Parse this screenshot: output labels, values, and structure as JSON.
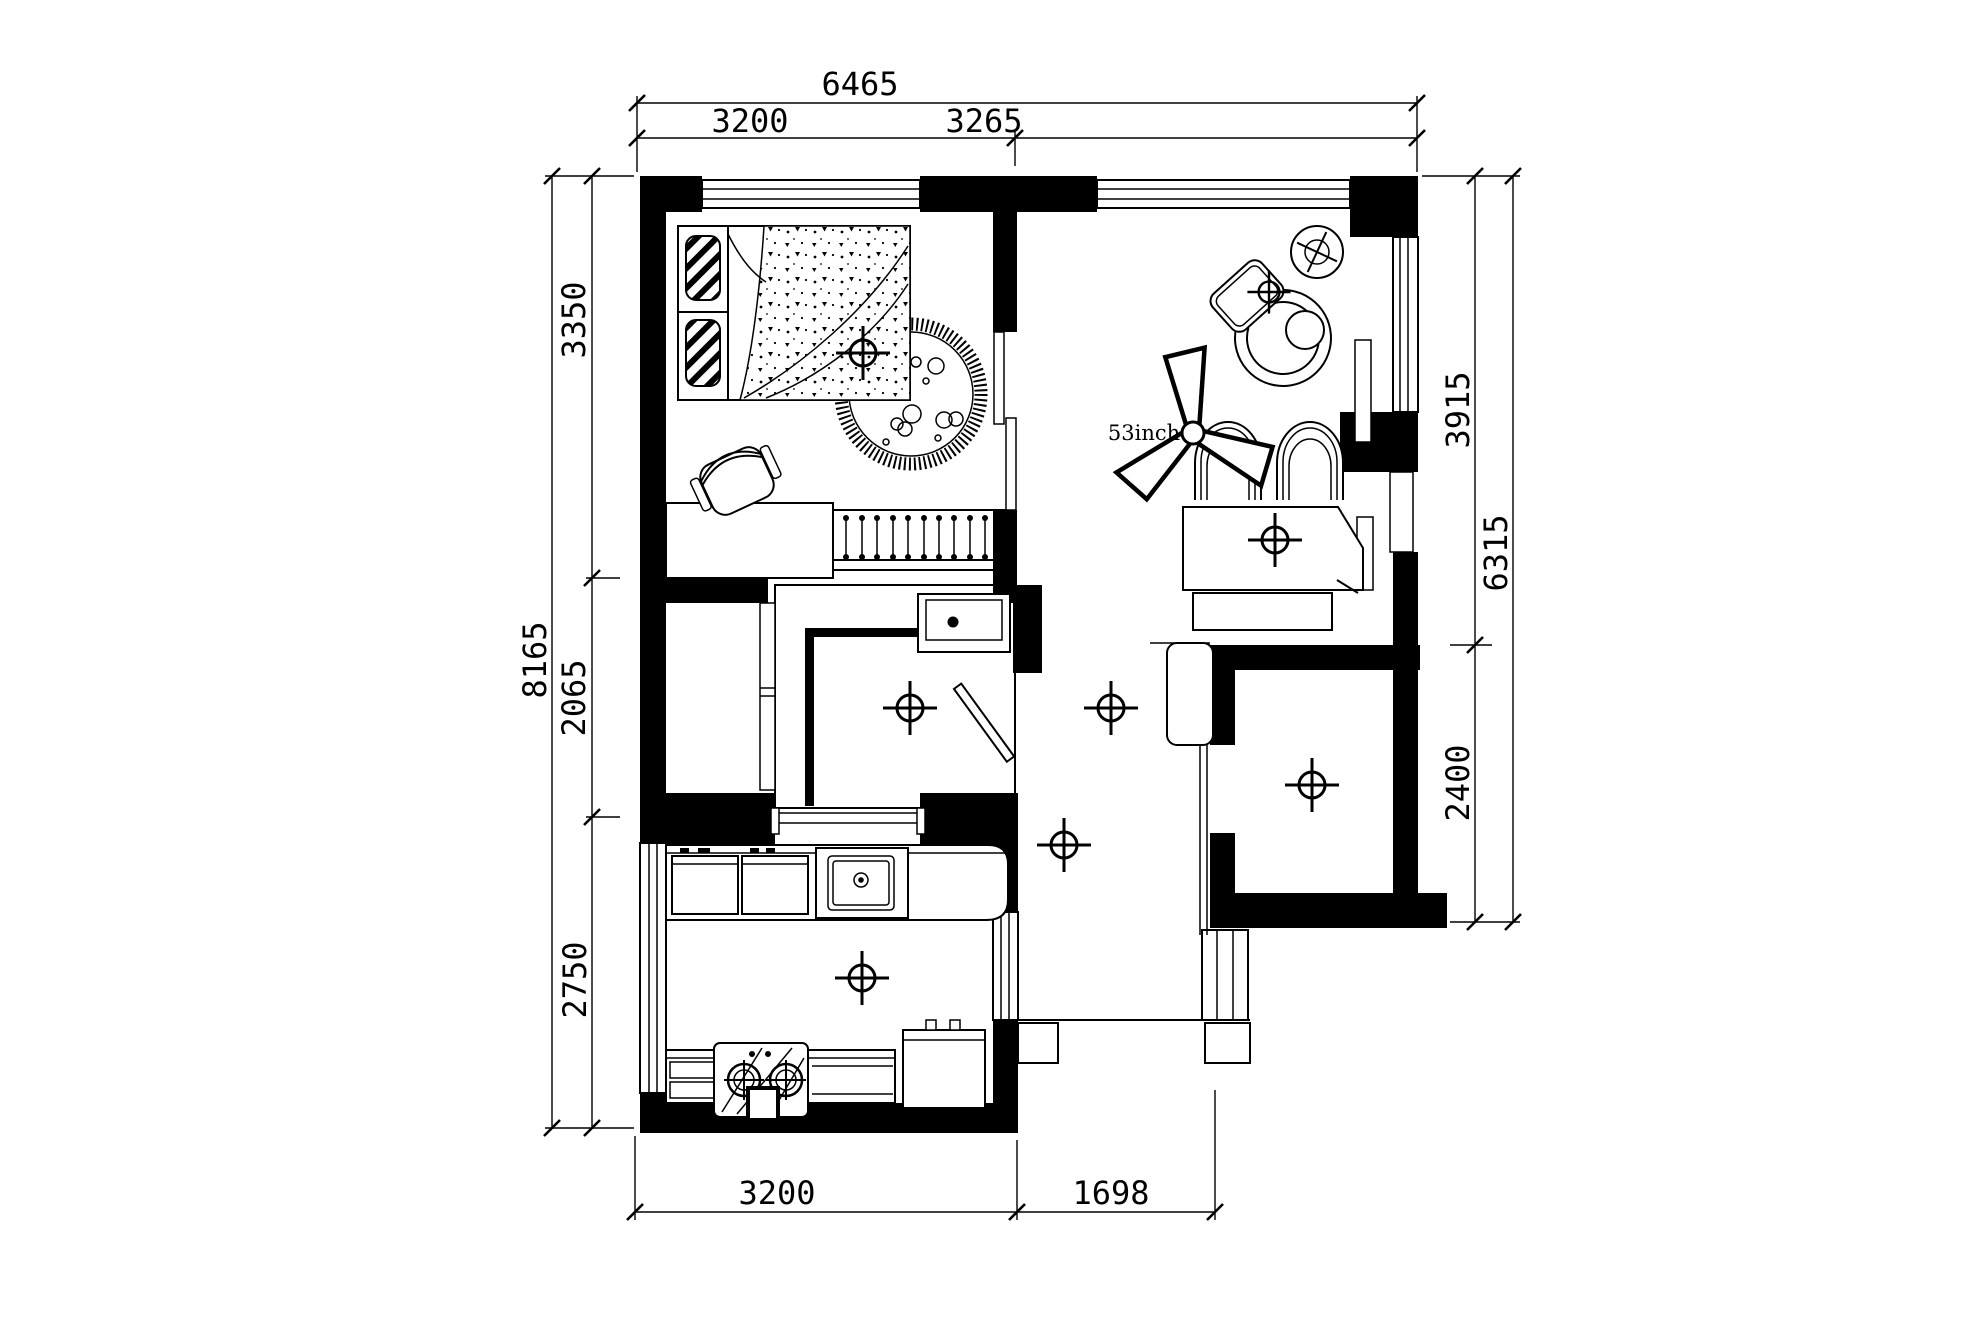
{
  "drawing": {
    "title": "apartment-floor-plan",
    "background_color": "#ffffff",
    "line_color": "#000000",
    "dimensions": {
      "top": {
        "total": "6465",
        "segments": [
          "3200",
          "3265"
        ]
      },
      "bottom": {
        "segments": [
          "3200",
          "1698"
        ]
      },
      "left": {
        "total": "8165",
        "segments": [
          "3350",
          "2065",
          "2750"
        ]
      },
      "right": {
        "total": "6315",
        "segments": [
          "3915",
          "2400"
        ]
      }
    },
    "annotations": {
      "fan_label": "53inch"
    },
    "symbols": {
      "ceiling_light": "crosshair-circle",
      "ceiling_fan": "three-blade-fan"
    }
  }
}
